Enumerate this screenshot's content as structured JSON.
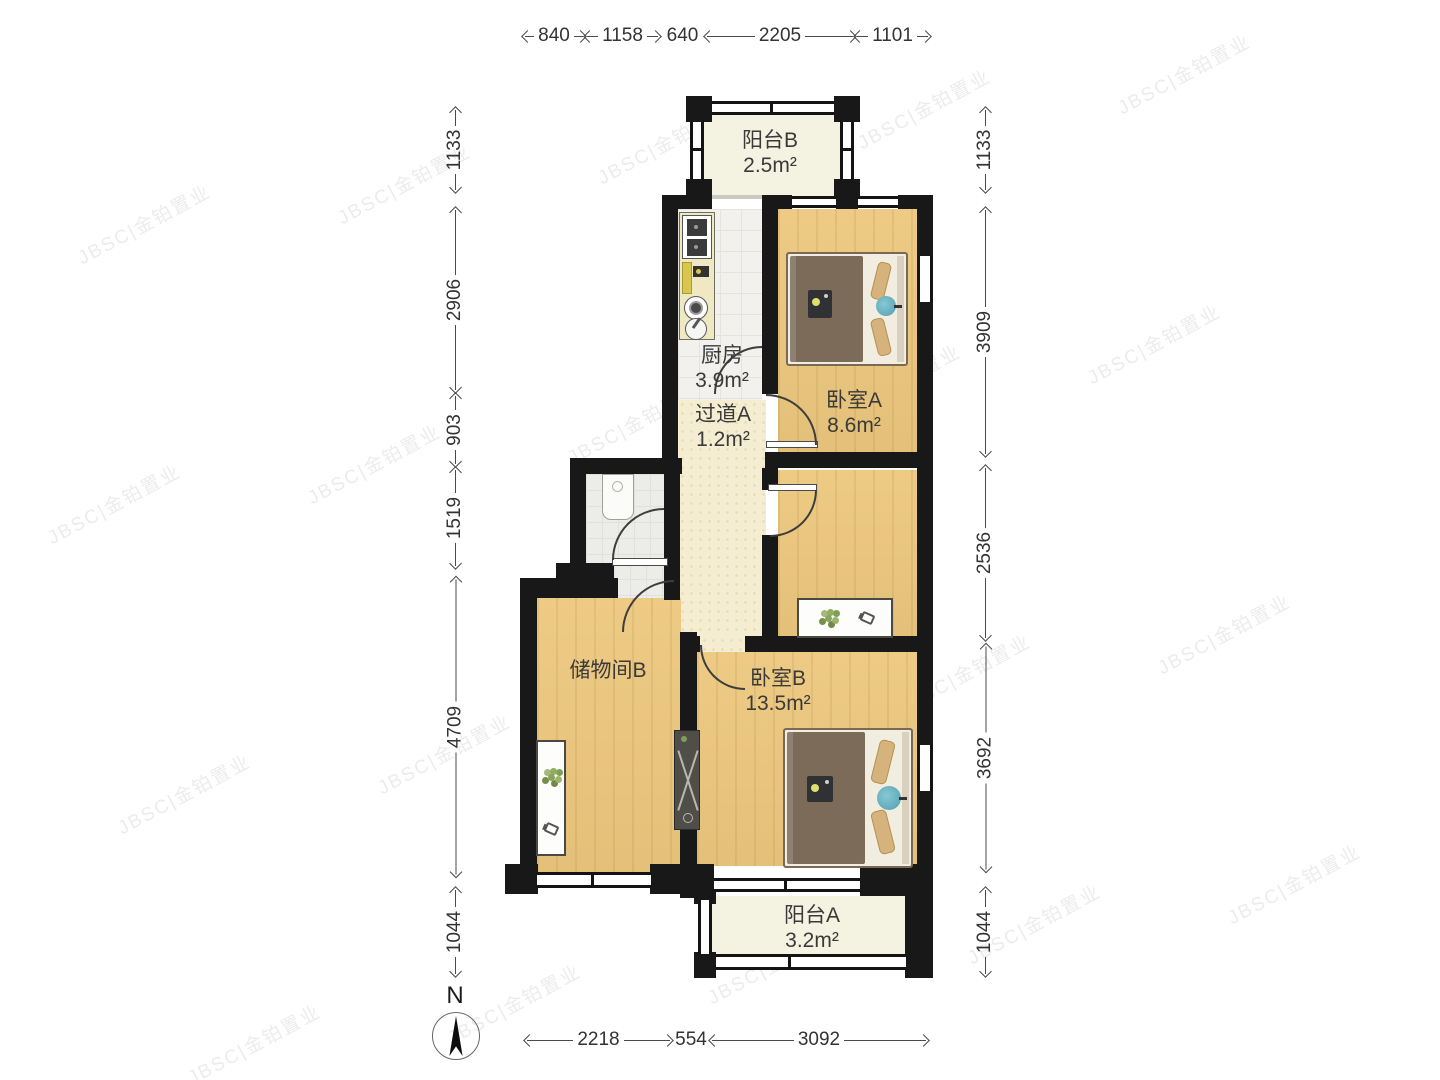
{
  "rooms": {
    "balcony_b": {
      "name": "阳台B",
      "area": "2.5m²"
    },
    "kitchen": {
      "name": "厨房",
      "area": "3.9m²"
    },
    "bedroom_a": {
      "name": "卧室A",
      "area": "8.6m²"
    },
    "hallway_a": {
      "name": "过道A",
      "area": "1.2m²"
    },
    "storage_b": {
      "name": "储物间B"
    },
    "bedroom_b": {
      "name": "卧室B",
      "area": "13.5m²"
    },
    "balcony_a": {
      "name": "阳台A",
      "area": "3.2m²"
    }
  },
  "dims": {
    "top": [
      "840",
      "1158",
      "640",
      "2205",
      "1101"
    ],
    "bottom": [
      "2218",
      "554",
      "3092"
    ],
    "left": [
      "1133",
      "2906",
      "903",
      "1519",
      "4709",
      "1044"
    ],
    "right": [
      "1133",
      "3909",
      "2536",
      "3692",
      "1044"
    ]
  },
  "compass": {
    "label": "N"
  },
  "watermark": {
    "text": "JBSC|金铂置业"
  },
  "colors": {
    "wall": "#181818",
    "wood": "#edc87e",
    "balcony": "#f4f2e1",
    "corridor": "#f4edd2",
    "kitchen_tile": "#f2f1ed",
    "bath": "#ececе8",
    "teal": "#66b5c4",
    "blanket": "#7b6b58",
    "pillow": "#d6b37c"
  }
}
